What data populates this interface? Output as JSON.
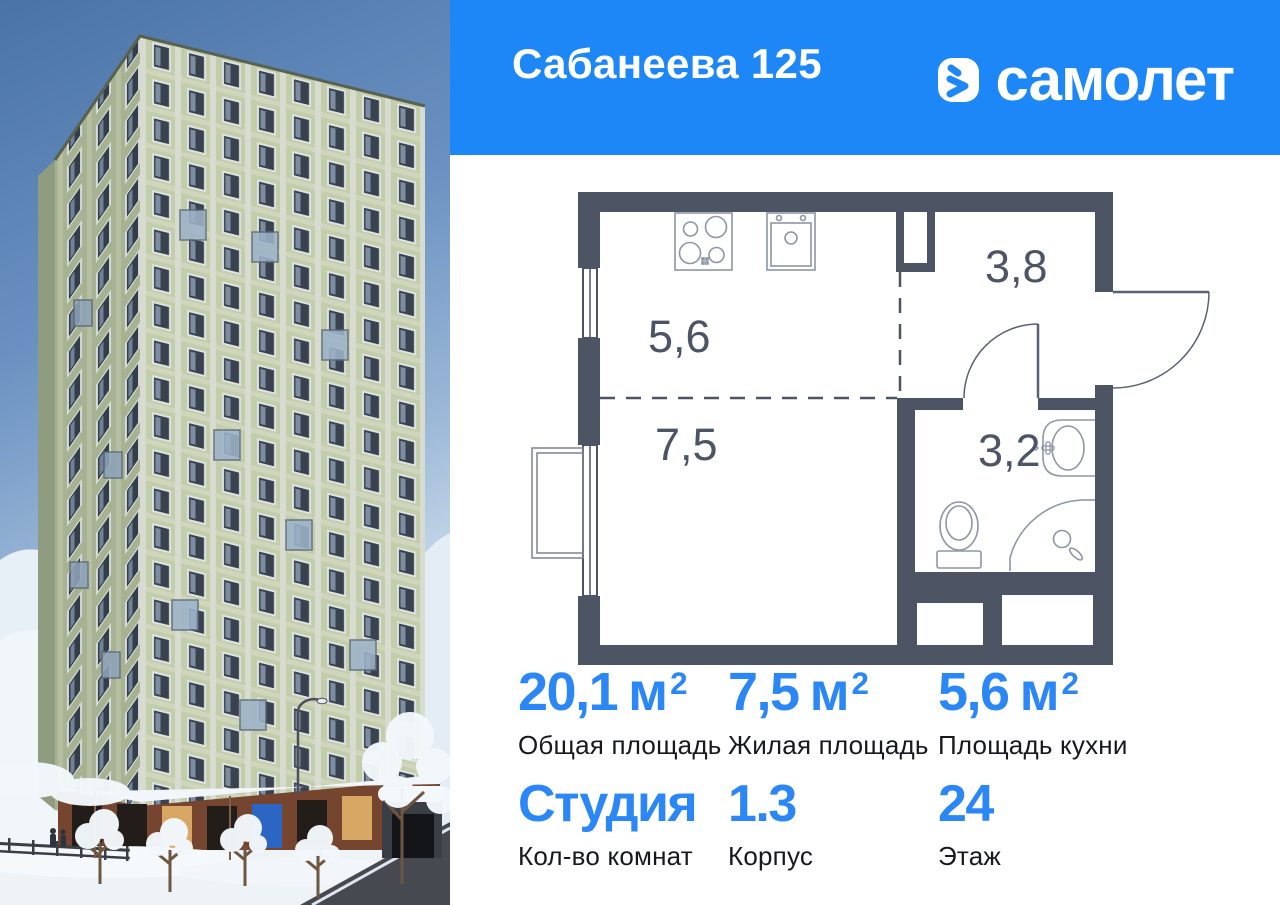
{
  "header": {
    "title": "Сабанеева 125",
    "brand": "самолет",
    "colors": {
      "header_bg": "#1e87f7",
      "brand_blue": "#1e87f7"
    }
  },
  "floor_plan": {
    "wall_color": "#4d5464",
    "rooms": [
      {
        "name": "kitchen",
        "area": "5,6"
      },
      {
        "name": "hallway",
        "area": "3,8"
      },
      {
        "name": "living-room",
        "area": "7,5"
      },
      {
        "name": "bathroom",
        "area": "3,2"
      }
    ]
  },
  "stats": {
    "accent_color": "#2b87f5",
    "cells": [
      {
        "value": "20,1",
        "unit": "м",
        "sup": "2",
        "label": "Общая площадь"
      },
      {
        "value": "7,5",
        "unit": "м",
        "sup": "2",
        "label": "Жилая площадь"
      },
      {
        "value": "5,6",
        "unit": "м",
        "sup": "2",
        "label": "Площадь кухни"
      },
      {
        "value": "Студия",
        "unit": "",
        "sup": "",
        "label": "Кол-во комнат"
      },
      {
        "value": "1.3",
        "unit": "",
        "sup": "",
        "label": "Корпус"
      },
      {
        "value": "24",
        "unit": "",
        "sup": "",
        "label": "Этаж"
      }
    ]
  }
}
